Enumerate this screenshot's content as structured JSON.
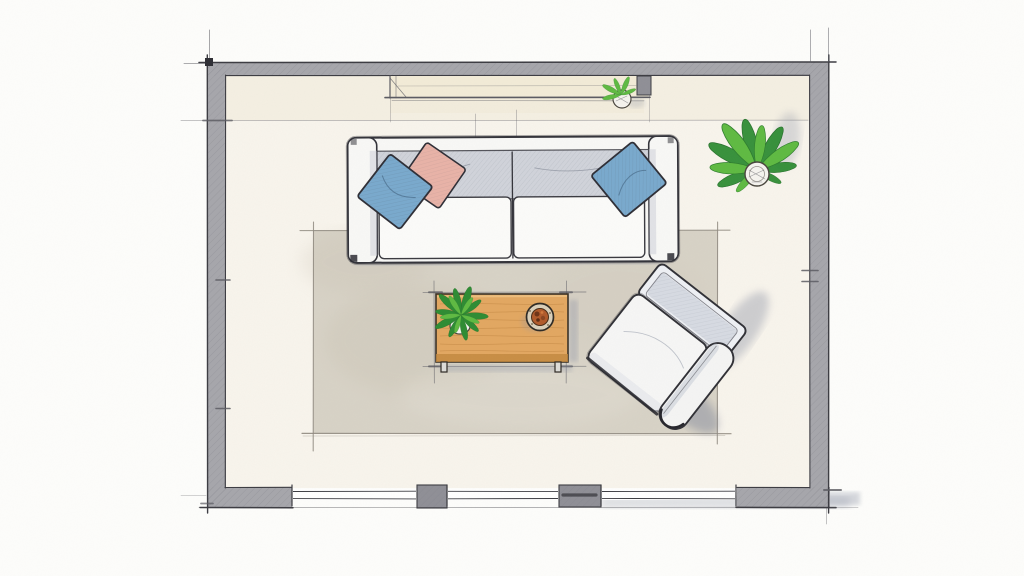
{
  "document": {
    "kind": "hand-drawn watercolor floor plan sketch",
    "room": "living room",
    "view": "top-down plan"
  },
  "colors": {
    "paper": "#fdfdfb",
    "room_wash": "#f8f4ec",
    "top_band_wash": "#f1ebdb",
    "wall": "#a6a6ab",
    "wall_dark": "#8f8f96",
    "wall_edge": "#3c3c42",
    "pencil": "#5b5b62",
    "window_glass": "#f1ead6",
    "rug": "#d7d2c6",
    "rug_mottle": "#c8c1b1",
    "rug_edge": "#8f8a80",
    "sofa": "#f8f8f6",
    "sofa_back_shade": "#c9ccd5",
    "pillow_blue": "#79a9cd",
    "pillow_pink": "#e8b2a7",
    "table_wood": "#e2a761",
    "table_wood_edge": "#c2883f",
    "wood_grain": "#bf8440",
    "leaf": "#5fba42",
    "leaf_dark": "#2e8c33",
    "pot": "#f5f3ee",
    "bowl_rim": "#d9cfba",
    "bowl_food": "#b05a2b",
    "chair": "#f6f6f5",
    "chair_shade": "#c2c8d4",
    "shadow": "#8e94a6"
  },
  "architecture": {
    "walls": [
      "top",
      "right",
      "bottom",
      "left"
    ],
    "top_window": {
      "label": "window niche with sill"
    },
    "bottom_windows": 3,
    "wall_piers": 2
  },
  "furniture": {
    "sofa": {
      "label": "two-seat sofa",
      "pillows": [
        "blue",
        "pink",
        "blue"
      ]
    },
    "rug": {
      "label": "area rug"
    },
    "coffee_table": {
      "label": "wooden coffee table",
      "items": [
        "potted plant",
        "food bowl"
      ]
    },
    "lounge_chair": {
      "label": "angled lounge chair"
    },
    "floor_plant": {
      "label": "potted floor plant"
    },
    "sill_plant": {
      "label": "small windowsill plant"
    }
  }
}
